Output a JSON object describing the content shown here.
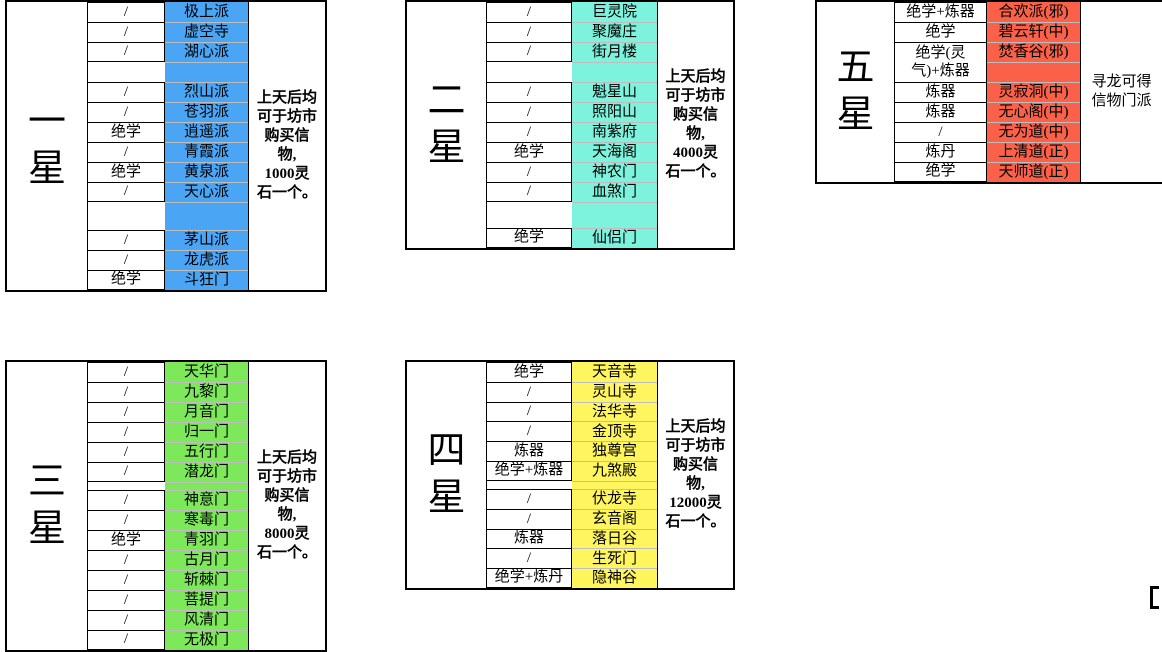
{
  "colors": {
    "grid": "#000000",
    "separator": "#BDBDBD",
    "background": "#FFFFFF",
    "one_star_highlight": "#4BA5F5",
    "two_star_highlight": "#7DF2DC",
    "three_star_highlight": "#7DE85A",
    "four_star_highlight": "#FFF55E",
    "five_star_highlight": "#FA6148"
  },
  "tables": [
    {
      "id": "one-star",
      "star_label": "一星",
      "star_chars": [
        "一",
        "星"
      ],
      "highlight_color": "#4BA5F5",
      "note_lines": [
        "上天后均",
        "可于坊市",
        "购买信",
        "物,",
        "1000灵",
        "石一个。"
      ],
      "groups": [
        [
          {
            "req": "/",
            "sect": "极上派"
          },
          {
            "req": "/",
            "sect": "虚空寺"
          },
          {
            "req": "/",
            "sect": "湖心派"
          }
        ],
        [
          {
            "req": "/",
            "sect": "烈山派"
          },
          {
            "req": "/",
            "sect": "苍羽派"
          },
          {
            "req": "绝学",
            "sect": "逍遥派"
          },
          {
            "req": "/",
            "sect": "青霞派"
          },
          {
            "req": "绝学",
            "sect": "黄泉派"
          },
          {
            "req": "/",
            "sect": "天心派"
          }
        ],
        [
          {
            "req": "/",
            "sect": "茅山派"
          },
          {
            "req": "/",
            "sect": "龙虎派"
          },
          {
            "req": "绝学",
            "sect": "斗狂门"
          }
        ]
      ]
    },
    {
      "id": "two-star",
      "star_label": "二星",
      "star_chars": [
        "二",
        "星"
      ],
      "highlight_color": "#7DF2DC",
      "note_lines": [
        "上天后均",
        "可于坊市",
        "购买信",
        "物,",
        "4000灵",
        "石一个。"
      ],
      "groups": [
        [
          {
            "req": "/",
            "sect": "巨灵院"
          },
          {
            "req": "/",
            "sect": "聚魔庄"
          },
          {
            "req": "/",
            "sect": "街月楼"
          }
        ],
        [
          {
            "req": "/",
            "sect": "魁星山"
          },
          {
            "req": "/",
            "sect": "照阳山"
          },
          {
            "req": "/",
            "sect": "南紫府"
          },
          {
            "req": "绝学",
            "sect": "天海阁"
          },
          {
            "req": "/",
            "sect": "神农门"
          },
          {
            "req": "/",
            "sect": "血煞门"
          }
        ],
        [
          {
            "req": "绝学",
            "sect": "仙侣门"
          }
        ]
      ]
    },
    {
      "id": "three-star",
      "star_label": "三星",
      "star_chars": [
        "三",
        "星"
      ],
      "highlight_color": "#7DE85A",
      "note_lines": [
        "上天后均",
        "可于坊市",
        "购买信",
        "物,",
        "8000灵",
        "石一个。"
      ],
      "groups": [
        [
          {
            "req": "/",
            "sect": "天华门"
          },
          {
            "req": "/",
            "sect": "九黎门"
          },
          {
            "req": "/",
            "sect": "月音门"
          },
          {
            "req": "/",
            "sect": "归一门"
          },
          {
            "req": "/",
            "sect": "五行门"
          },
          {
            "req": "/",
            "sect": "潜龙门"
          }
        ],
        [
          {
            "req": "/",
            "sect": "神意门"
          },
          {
            "req": "/",
            "sect": "寒毒门"
          },
          {
            "req": "绝学",
            "sect": "青羽门"
          },
          {
            "req": "/",
            "sect": "古月门"
          },
          {
            "req": "/",
            "sect": "斩棘门"
          },
          {
            "req": "/",
            "sect": "菩提门"
          },
          {
            "req": "/",
            "sect": "风清门"
          },
          {
            "req": "/",
            "sect": "无极门"
          }
        ]
      ]
    },
    {
      "id": "four-star",
      "star_label": "四星",
      "star_chars": [
        "四",
        "星"
      ],
      "highlight_color": "#FFF55E",
      "note_lines": [
        "上天后均",
        "可于坊市",
        "购买信",
        "物,",
        "12000灵",
        "石一个。"
      ],
      "groups": [
        [
          {
            "req": "绝学",
            "sect": "天音寺"
          },
          {
            "req": "/",
            "sect": "灵山寺"
          },
          {
            "req": "/",
            "sect": "法华寺"
          },
          {
            "req": "/",
            "sect": "金顶寺"
          },
          {
            "req": "炼器",
            "sect": "独尊宫"
          },
          {
            "req": "绝学+炼器",
            "sect": "九煞殿"
          }
        ],
        [
          {
            "req": "/",
            "sect": "伏龙寺"
          },
          {
            "req": "/",
            "sect": "玄音阁"
          },
          {
            "req": "炼器",
            "sect": "落日谷"
          },
          {
            "req": "/",
            "sect": "生死门"
          },
          {
            "req": "绝学+炼丹",
            "sect": "隐神谷"
          }
        ]
      ]
    },
    {
      "id": "five-star",
      "star_label": "五星",
      "star_chars": [
        "五",
        "星"
      ],
      "highlight_color": "#FA6148",
      "note_lines": [
        "寻龙可得",
        "信物门派"
      ],
      "groups": [
        [
          {
            "req": "绝学+炼器",
            "sect": "合欢派(邪)"
          },
          {
            "req": "绝学",
            "sect": "碧云轩(中)"
          },
          {
            "req": "绝学(灵气)+炼器",
            "sect": "焚香谷(邪)",
            "tall": true
          },
          {
            "req": "炼器",
            "sect": "灵寂洞(中)"
          },
          {
            "req": "炼器",
            "sect": "无心阁(中)"
          },
          {
            "req": "/",
            "sect": "无为道(中)"
          },
          {
            "req": "炼丹",
            "sect": "上清道(正)"
          },
          {
            "req": "绝学",
            "sect": "天师道(正)"
          }
        ]
      ]
    }
  ]
}
